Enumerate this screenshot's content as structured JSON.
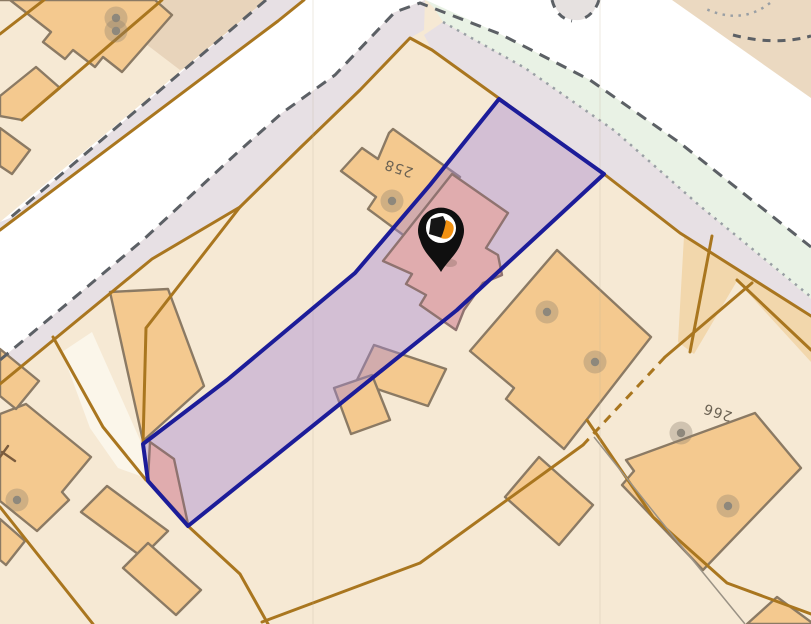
{
  "map": {
    "description": "cadastral-parcel-map",
    "selected_parcel": {
      "points": "499,99 604,174 457,310 188,526 148,481 143,444 227,380 355,273 430,185",
      "fill": "rgba(163,133,212,0.42)",
      "border_color": "#1c1c99",
      "border_width": 4
    },
    "colors": {
      "base_parcel": "#f6e9d4",
      "road": "#ffffff",
      "verge": "#e7e0e4",
      "green_strip": "#e9f2e5",
      "building": "#f4c98f",
      "building_outline": "#8b7a64",
      "selected_building": "#e0acae",
      "selected_building_outline": "#8f7370",
      "parcel_line": "#a9761f",
      "dashed_line": "#5c6065",
      "dotted_line": "#999fa4",
      "label_color": "#6b6253",
      "pin_black": "#0f0f0f",
      "pin_orange": "#f29111",
      "address_dot": "#8e887c",
      "address_halo": "rgba(138,127,110,0.35)"
    },
    "ground": [
      {
        "name": "parcel-tan-topleft",
        "points": "148,0 290,0 298,14 180,70 138,38",
        "fill": "#e8d4bb"
      },
      {
        "name": "road-junction-white",
        "points": "266,0 425,0 393,13 335,75 282,113 238,152 143,240 0,360 0,222",
        "fill": "#ffffff"
      },
      {
        "name": "road-top-white",
        "points": "425,0 811,0 811,247 680,143 590,80 500,34",
        "fill": "#ffffff"
      },
      {
        "name": "parcel-tan-topright",
        "points": "672,0 811,0 811,98",
        "fill": "#ebd9c1"
      },
      {
        "name": "green-strip",
        "points": "426,0 500,34 590,80 680,143 811,247 811,299 700,206 615,131 525,68 443,22 434,8",
        "fill": "#e9f2e5"
      },
      {
        "name": "verge-road-top",
        "points": "443,22 525,68 615,131 700,206 811,299 811,317 680,233 604,174 432,50 424,35",
        "fill": "#e7e0e4"
      },
      {
        "name": "verge-road-left-nw",
        "points": "304,0 266,0 10,218 0,222 0,232 278,22",
        "fill": "#e7e0e4"
      },
      {
        "name": "verge-road-left-se",
        "points": "425,0 393,13 335,75 282,113 238,152 143,240 0,360 0,385 152,259 240,207 300,148 360,90 410,38 424,30",
        "fill": "#e7e0e4"
      },
      {
        "name": "parcel-tan-right",
        "points": "684,236 811,318 811,362 737,281 694,354 678,342",
        "fill": "#f2d7ac"
      },
      {
        "name": "access-path",
        "points": "62,352 92,332 140,440 146,478 118,468 90,428",
        "fill": "#fbf6ea"
      }
    ],
    "driveway_stub": {
      "name": "driveway-stub",
      "d": "M553,0 C556,13 565,21 579,20 C590,19 596,10 598,0 Z",
      "fill": "#e6e1e0"
    },
    "buildings": [
      {
        "name": "building-topleft-large",
        "points": "0,0 155,0 172,15 122,72 103,57 95,67 73,50 65,59 43,42 51,32 10,0"
      },
      {
        "name": "building-topleft-annex",
        "points": "0,96 36,67 60,88 22,120 0,116"
      },
      {
        "name": "building-topleft-annex2",
        "points": "0,128 30,150 12,174 0,166"
      },
      {
        "name": "building-258",
        "points": "393,129 460,177 406,237 368,209 376,197 341,171 362,148 378,159 389,133"
      },
      {
        "name": "building-strip-west",
        "points": "110,292 168,289 204,386 143,441"
      },
      {
        "name": "building-mid-a",
        "points": "374,345 446,369 428,406 356,382"
      },
      {
        "name": "building-mid-b",
        "points": "334,388 372,375 390,420 351,434"
      },
      {
        "name": "building-south-a",
        "points": "107,486 168,531 142,557 81,512"
      },
      {
        "name": "building-south-b",
        "points": "148,543 201,590 176,615 123,568"
      },
      {
        "name": "building-bottomleft-large",
        "points": "26,404 91,457 62,492 69,500 37,531 0,501 0,414"
      },
      {
        "name": "building-bottomleft-s1",
        "points": "0,349 39,381 16,409 0,396"
      },
      {
        "name": "building-bottomleft-s2",
        "points": "0,519 25,541 6,565 0,560"
      },
      {
        "name": "building-east-large",
        "points": "557,250 651,337 564,449 506,399 514,388 470,351"
      },
      {
        "name": "building-east-small",
        "points": "539,457 593,505 559,545 505,497"
      },
      {
        "name": "building-266",
        "points": "755,413 801,468 703,570 622,485 634,471 626,460"
      },
      {
        "name": "building-corner-br",
        "points": "747,624 777,597 811,622 811,624"
      }
    ],
    "selected_buildings": [
      {
        "name": "selected-building-main",
        "points": "452,174 508,213 486,248 498,255 502,275 483,283 464,310 456,330 420,305 426,295 406,284 412,274 383,261"
      },
      {
        "name": "selected-building-tip",
        "points": "150,442 174,459 188,524 148,480"
      }
    ],
    "parcel_lines": [
      {
        "name": "parcel-line-road-nw",
        "points": "304,0 278,21 0,230"
      },
      {
        "name": "parcel-line-road-main",
        "points": "240,207 300,148 360,90 410,38 432,50 604,174 680,233 811,316"
      },
      {
        "name": "parcel-line-verge-sw",
        "points": "0,384 152,259 240,207"
      },
      {
        "name": "parcel-line-flag-west",
        "points": "240,207 146,328 143,444"
      },
      {
        "name": "parcel-line-path-west",
        "points": "53,337 103,427 146,480"
      },
      {
        "name": "parcel-line-tip-south",
        "points": "188,526 240,574 268,624"
      },
      {
        "name": "parcel-line-bottomleft",
        "points": "0,507 93,624"
      },
      {
        "name": "parcel-line-tl-a",
        "points": "44,0 0,34"
      },
      {
        "name": "parcel-line-tl-b",
        "points": "162,0 22,120"
      },
      {
        "name": "parcel-line-east-a",
        "points": "752,283 665,357"
      },
      {
        "name": "parcel-line-south-long",
        "points": "583,445 420,563 262,622"
      },
      {
        "name": "parcel-line-se-long",
        "points": "587,420 653,517 727,583 811,614"
      },
      {
        "name": "parcel-line-right-a",
        "points": "712,236 690,352"
      },
      {
        "name": "parcel-line-right-b",
        "points": "737,280 811,350"
      }
    ],
    "dashed_brown_lines": [
      {
        "name": "parcel-line-dashed-mid",
        "points": "665,357 583,445"
      }
    ],
    "thin_gray_lines": [
      {
        "name": "boundary-thin-gray",
        "points": "594,437 660,520 745,624"
      }
    ],
    "dashed_dark_lines": [
      {
        "name": "road-edge-dashed-nw",
        "points": "266,0 10,218"
      },
      {
        "name": "road-edge-dashed-long",
        "points": "0,360 143,240 238,152 282,113 335,75 395,12 420,3 500,34 590,80 680,143 811,247"
      }
    ],
    "dashed_dark_paths": [
      {
        "name": "driveway-dashed-a",
        "d": "M552,0 C555,12 562,19 572,21"
      },
      {
        "name": "driveway-dashed-b",
        "d": "M599,0 C596,10 589,17 580,20"
      },
      {
        "name": "roundabout-dashed-arc",
        "d": "M733,35 Q775,46 811,36"
      }
    ],
    "dotted_lines": [
      {
        "name": "green-strip-dotted",
        "points": "443,22 525,68 615,131 700,206 811,297"
      }
    ],
    "dotted_paths": [
      {
        "name": "corner-dotted-arc",
        "d": "M770,3 Q742,25 706,9"
      }
    ],
    "seams": [
      {
        "name": "tile-seam-a",
        "x": 313
      },
      {
        "name": "tile-seam-b",
        "x": 600
      }
    ],
    "address_points": [
      {
        "x": 116,
        "y": 18
      },
      {
        "x": 116,
        "y": 31
      },
      {
        "x": 392,
        "y": 201
      },
      {
        "x": 547,
        "y": 312
      },
      {
        "x": 595,
        "y": 362
      },
      {
        "x": 681,
        "y": 433
      },
      {
        "x": 728,
        "y": 506
      },
      {
        "x": 17,
        "y": 500
      }
    ],
    "symbols": [
      {
        "name": "survey-t-symbol",
        "d": "M2,452 L15,461 M8,446 L0,457",
        "color": "#7a5c3e"
      }
    ],
    "labels": [
      {
        "name": "parcel-label-258",
        "text": "258",
        "x": 400,
        "y": 164,
        "rotate": 198
      },
      {
        "name": "parcel-label-266",
        "text": "266",
        "x": 719,
        "y": 408,
        "rotate": 198
      }
    ],
    "pin": {
      "name": "location-pin",
      "shadow": {
        "cx": 450,
        "cy": 263,
        "rx": 7,
        "ry": 4,
        "fill": "rgba(90,70,60,0.25)"
      },
      "teardrop": "M441,272 C434,260 424,254 420,240 A23,23 0 1 1 462,240 C458,254 448,260 441,272 Z",
      "inner_circle": {
        "cx": 441,
        "cy": 228,
        "r": 15
      },
      "logo_dark": "M431,219 L443,216 L448,226 L442,238 L429,234 Z",
      "logo_orange": "M446,220 Q456,223 453,232 Q450,241 441,238 Q445,229 446,220 Z"
    }
  }
}
